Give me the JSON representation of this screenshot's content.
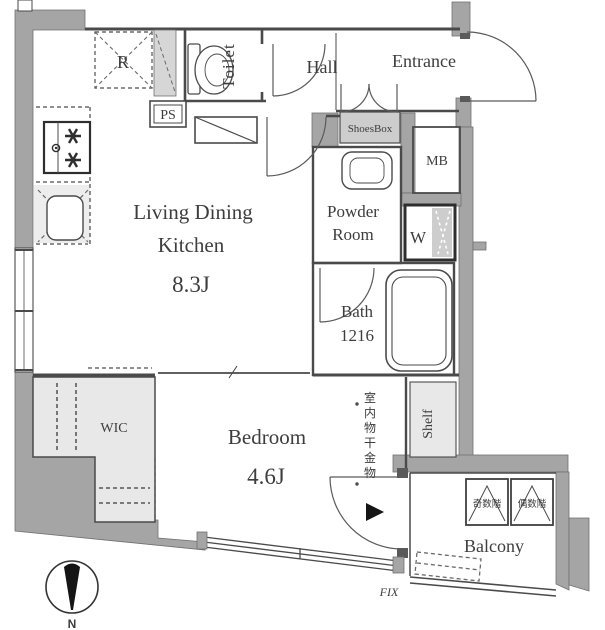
{
  "title": "apartment-floor-plan",
  "rooms": {
    "ldk": {
      "line1": "Living Dining",
      "line2": "Kitchen",
      "size": "8.3J"
    },
    "bedroom": {
      "name": "Bedroom",
      "size": "4.6J"
    },
    "wic": {
      "name": "WIC"
    },
    "toilet": {
      "name": "Toilet"
    },
    "hall": {
      "name": "Hall"
    },
    "entrance": {
      "name": "Entrance"
    },
    "powder": {
      "line1": "Powder",
      "line2": "Room"
    },
    "bath": {
      "name": "Bath",
      "size": "1216"
    },
    "balcony": {
      "name": "Balcony"
    }
  },
  "fixtures": {
    "refrigerator": "R",
    "pipe_space": "PS",
    "meter_box": "MB",
    "shoes_box": "ShoesBox",
    "washer": "W",
    "shelf": "Shelf",
    "laundry_hardware": "室内物干金物",
    "balcony_partition_odd": "奇数階",
    "balcony_partition_even": "偶数階",
    "fixed_window": "FIX"
  },
  "compass": {
    "north": "N"
  },
  "colors": {
    "wall": "#a5a5a5",
    "wall_edge": "#707070",
    "line": "#4a4a4a",
    "light_fill": "#e8e8e8",
    "mid_fill": "#cdcdcd",
    "text": "#3d3d3d",
    "background": "#ffffff"
  }
}
